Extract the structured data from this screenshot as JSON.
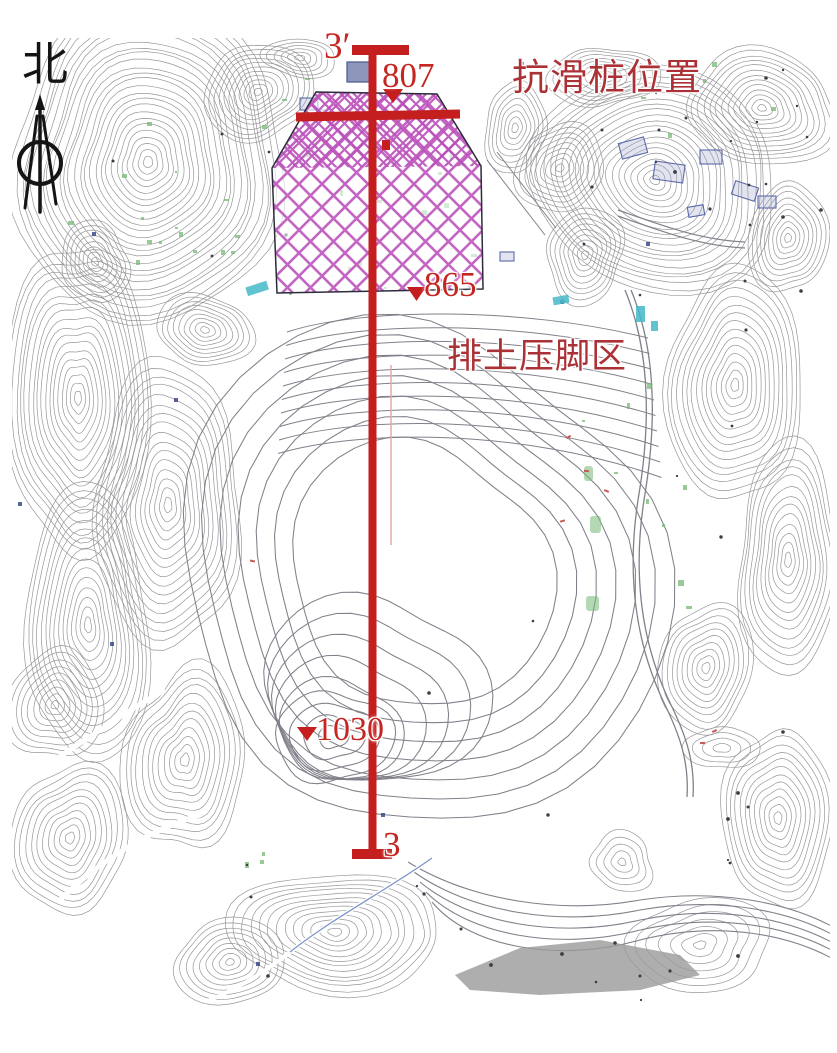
{
  "figure": {
    "type": "topographic-site-map",
    "north_label": "北",
    "section_line": {
      "start_label": "3′",
      "end_label": "3"
    },
    "labels": {
      "anti_slide_pile": "抗滑桩位置",
      "dump_toe_area": "排土压脚区"
    },
    "elevation_markers": [
      {
        "id": "elev-807",
        "value": "807"
      },
      {
        "id": "elev-865",
        "value": "865"
      },
      {
        "id": "elev-1030",
        "value": "1030"
      }
    ],
    "colors": {
      "section_red": "#c41e1e",
      "elevation_red": "#c52622",
      "annotation_red": "#ab3136",
      "hatch_magenta": "#c05ec0",
      "hatch_magenta_dense": "#b94fb9",
      "contour_gray": "#97979b",
      "bench_gray": "#80808a",
      "vegetation_green": "#74b874",
      "water_cyan": "#46b9c8",
      "structure_blue": "#5c68a8",
      "ink": "#141414"
    }
  }
}
